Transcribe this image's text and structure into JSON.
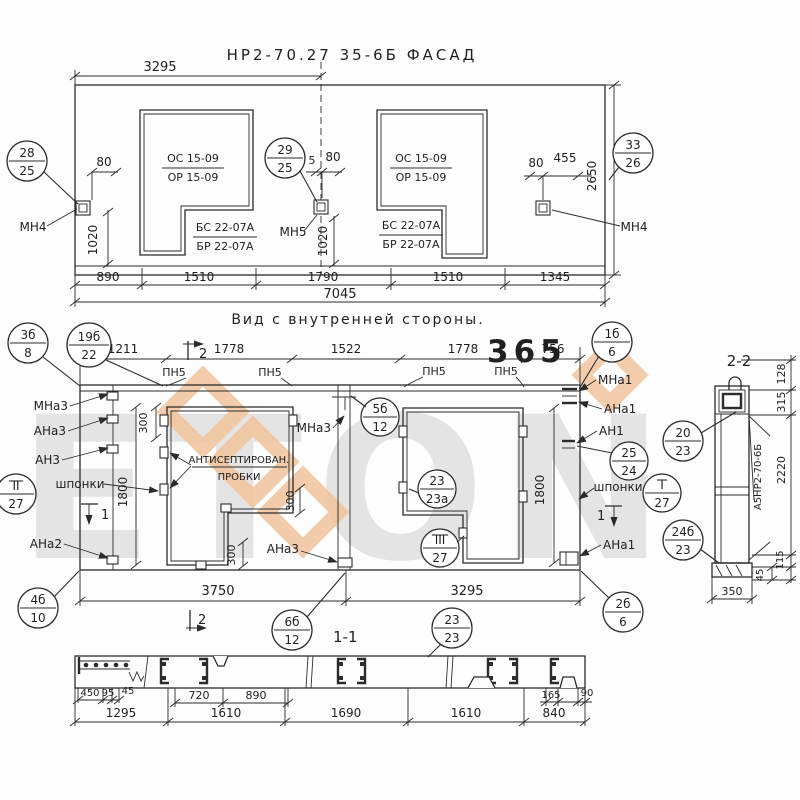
{
  "watermark": {
    "brand": "ETON",
    "number": "365",
    "tan": "#f1c49c",
    "orange": "#ee9166"
  },
  "facade": {
    "title": "НР2-70.27 35-6Б  ФАСАД",
    "window": {
      "os": "ОС 15-09",
      "or": "ОР 15-09",
      "bs": "БС 22-07А",
      "br": "БР 22-07А"
    },
    "labels": {
      "mn4": "МН4",
      "mn5": "МН5"
    },
    "balloons": {
      "b28": {
        "num": "28",
        "den": "25"
      },
      "b29": {
        "num": "29",
        "den": "25"
      },
      "b33": {
        "num": "33",
        "den": "26"
      }
    },
    "dims": {
      "top": "3295",
      "d80": "80",
      "d5": "5",
      "d455": "455",
      "v1020": "1020",
      "v2650": "2650",
      "row": [
        "890",
        "1510",
        "1790",
        "1510",
        "1345"
      ],
      "total": "7045"
    }
  },
  "inner": {
    "title": "Вид с внутренней стороны.",
    "labels": {
      "pn5": "ПН5",
      "mna3": "МНа3",
      "ana3": "АНа3",
      "an3": "АН3",
      "ana2": "АНа2",
      "mna1": "МНа1",
      "ana1": "АНа1",
      "an1": "АН1",
      "shponki": "шпонки",
      "antiseptic1": "АНТИСЕПТИРОВАН.",
      "antiseptic2": "ПРОБКИ",
      "marker1": "1",
      "marker2": "2"
    },
    "balloons": {
      "b3b": {
        "num": "3б",
        "den": "8"
      },
      "b19b": {
        "num": "19б",
        "den": "22"
      },
      "b1b": {
        "num": "1б",
        "den": "6"
      },
      "b5b": {
        "num": "5б",
        "den": "12"
      },
      "b23a": {
        "num": "23",
        "den": "23а"
      },
      "bII": {
        "num": "II",
        "den": "27"
      },
      "bIII": {
        "num": "III",
        "den": "27"
      },
      "bI": {
        "num": "I",
        "den": "27"
      },
      "b25": {
        "num": "25",
        "den": "24"
      },
      "b4b": {
        "num": "4б",
        "den": "10"
      },
      "b6b": {
        "num": "6б",
        "den": "12"
      },
      "b2b": {
        "num": "2б",
        "den": "6"
      },
      "b23": {
        "num": "23",
        "den": "23"
      }
    },
    "dims": {
      "row": [
        "1211",
        "1778",
        "1522",
        "1778",
        "756"
      ],
      "v1800": "1800",
      "v300": "300",
      "b3750": "3750",
      "b3295": "3295"
    }
  },
  "section22": {
    "title": "2-2",
    "mark": "А5НР2-70-6Б",
    "dims": {
      "d128": "128",
      "d315": "315",
      "d2220": "2220",
      "d115": "115",
      "d45": "45",
      "d350": "350"
    },
    "balloons": {
      "b20": {
        "num": "20",
        "den": "23"
      },
      "b24b": {
        "num": "24б",
        "den": "23"
      }
    }
  },
  "section11": {
    "title": "1-1",
    "dims": {
      "row1": [
        "450",
        "95",
        "45",
        "720",
        "890",
        "165",
        "90"
      ],
      "row2": [
        "1295",
        "1610",
        "1690",
        "1610",
        "840"
      ]
    }
  }
}
